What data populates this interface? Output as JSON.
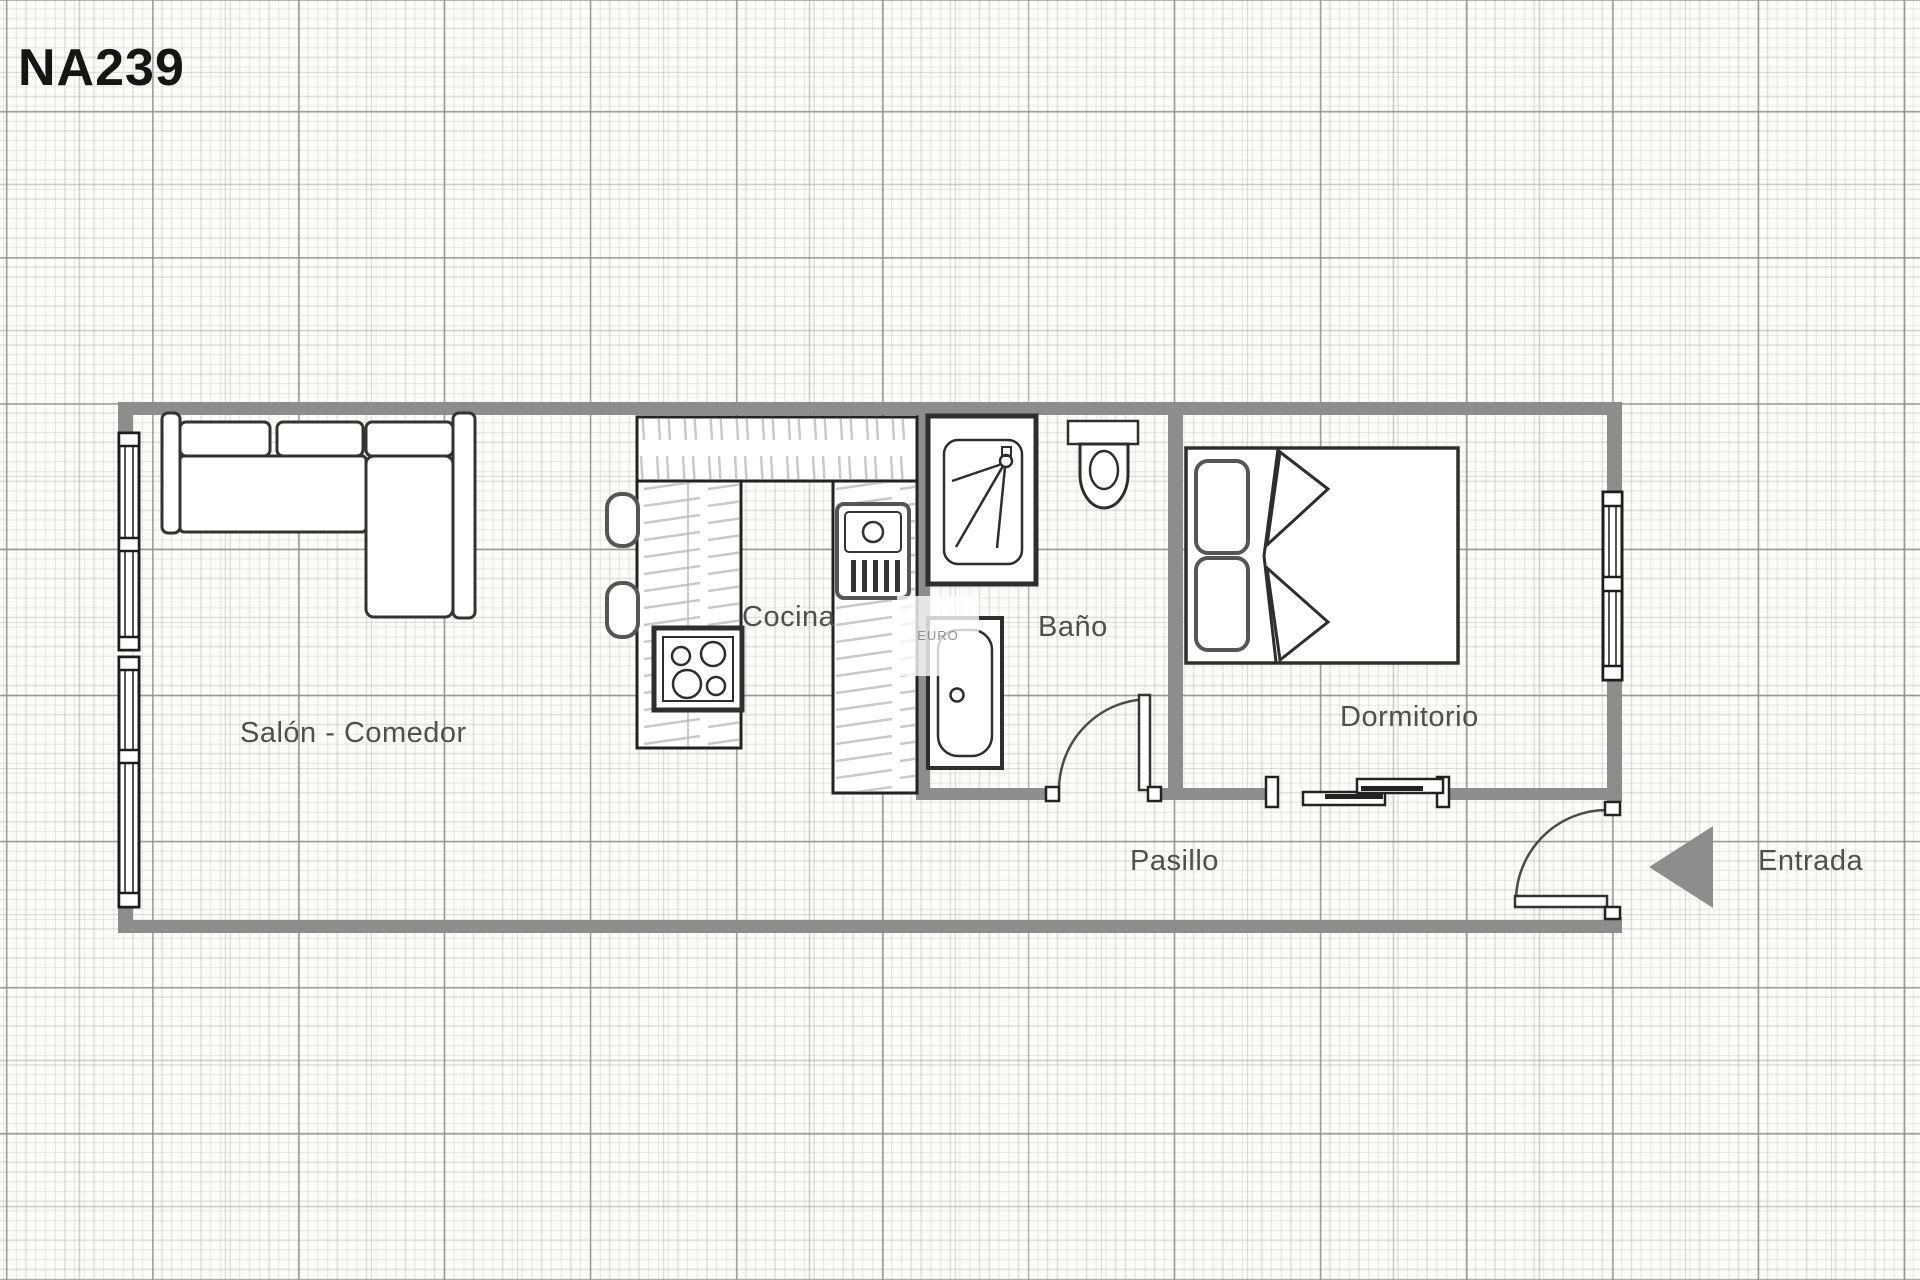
{
  "title": "NA239",
  "plan": {
    "room_labels": {
      "salon": "Salón - Comedor",
      "cocina": "Cocina",
      "bano": "Baño",
      "dormitorio": "Dormitorio",
      "pasillo": "Pasillo"
    },
    "entrance_label": "Entrada",
    "watermark_text": "EURO",
    "fixtures": [
      "l-shaped-sofa",
      "kitchen-counter-hatched",
      "bar-stools",
      "cooktop-4-burners",
      "kitchen-sink-unit",
      "shower",
      "toilet",
      "bathtub",
      "double-bed-with-pillows",
      "left-wall-windows",
      "bedroom-window",
      "bathroom-hinged-door",
      "entry-hinged-door",
      "bedroom-sliding-door",
      "entrance-arrow"
    ],
    "colors": {
      "wall": "#8d8d8d",
      "fixture_outline": "#2e2e2e",
      "fixture_secondary": "#555555",
      "hatch": "#c9c9c9",
      "label_text": "#4f4f4f",
      "title_text": "#151515",
      "paper": "#fbfbf9",
      "entrance_arrow": "#8d8d8d"
    }
  }
}
